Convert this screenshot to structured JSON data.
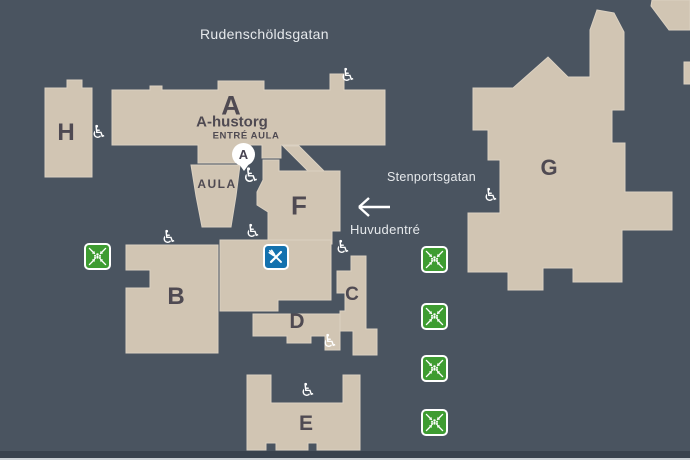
{
  "map": {
    "streets": {
      "rudenscholdsgatan": "Rudenschöldsgatan",
      "stenportsgatan": "Stenportsgatan"
    },
    "entrance": {
      "huvudentre_label": "Huvudentré"
    },
    "buildings": {
      "a": "A",
      "b": "B",
      "c": "C",
      "d": "D",
      "e": "E",
      "f": "F",
      "g": "G",
      "h": "H"
    },
    "areas": {
      "a_hustorg": "A-hustorg",
      "entre_aula": "ENTRÉ AULA",
      "aula": "AULA",
      "aula_marker": "A"
    },
    "icons": {
      "wheelchair_glyph": "♿",
      "wheelchair_meaning": "accessible-entrance",
      "restaurant_meaning": "restaurant",
      "assembly_meaning": "assembly-point",
      "arrow_meaning": "main-entrance-direction"
    },
    "colors": {
      "background": "#4a5460",
      "building": "#d1c5b3",
      "building_label": "#4f4a52",
      "street_label": "#e6e9ec",
      "assembly_green": "#3e9c31",
      "restaurant_blue": "#1371ae",
      "footer_bar": "#39424e",
      "footer_line": "#ccd1d6"
    }
  }
}
